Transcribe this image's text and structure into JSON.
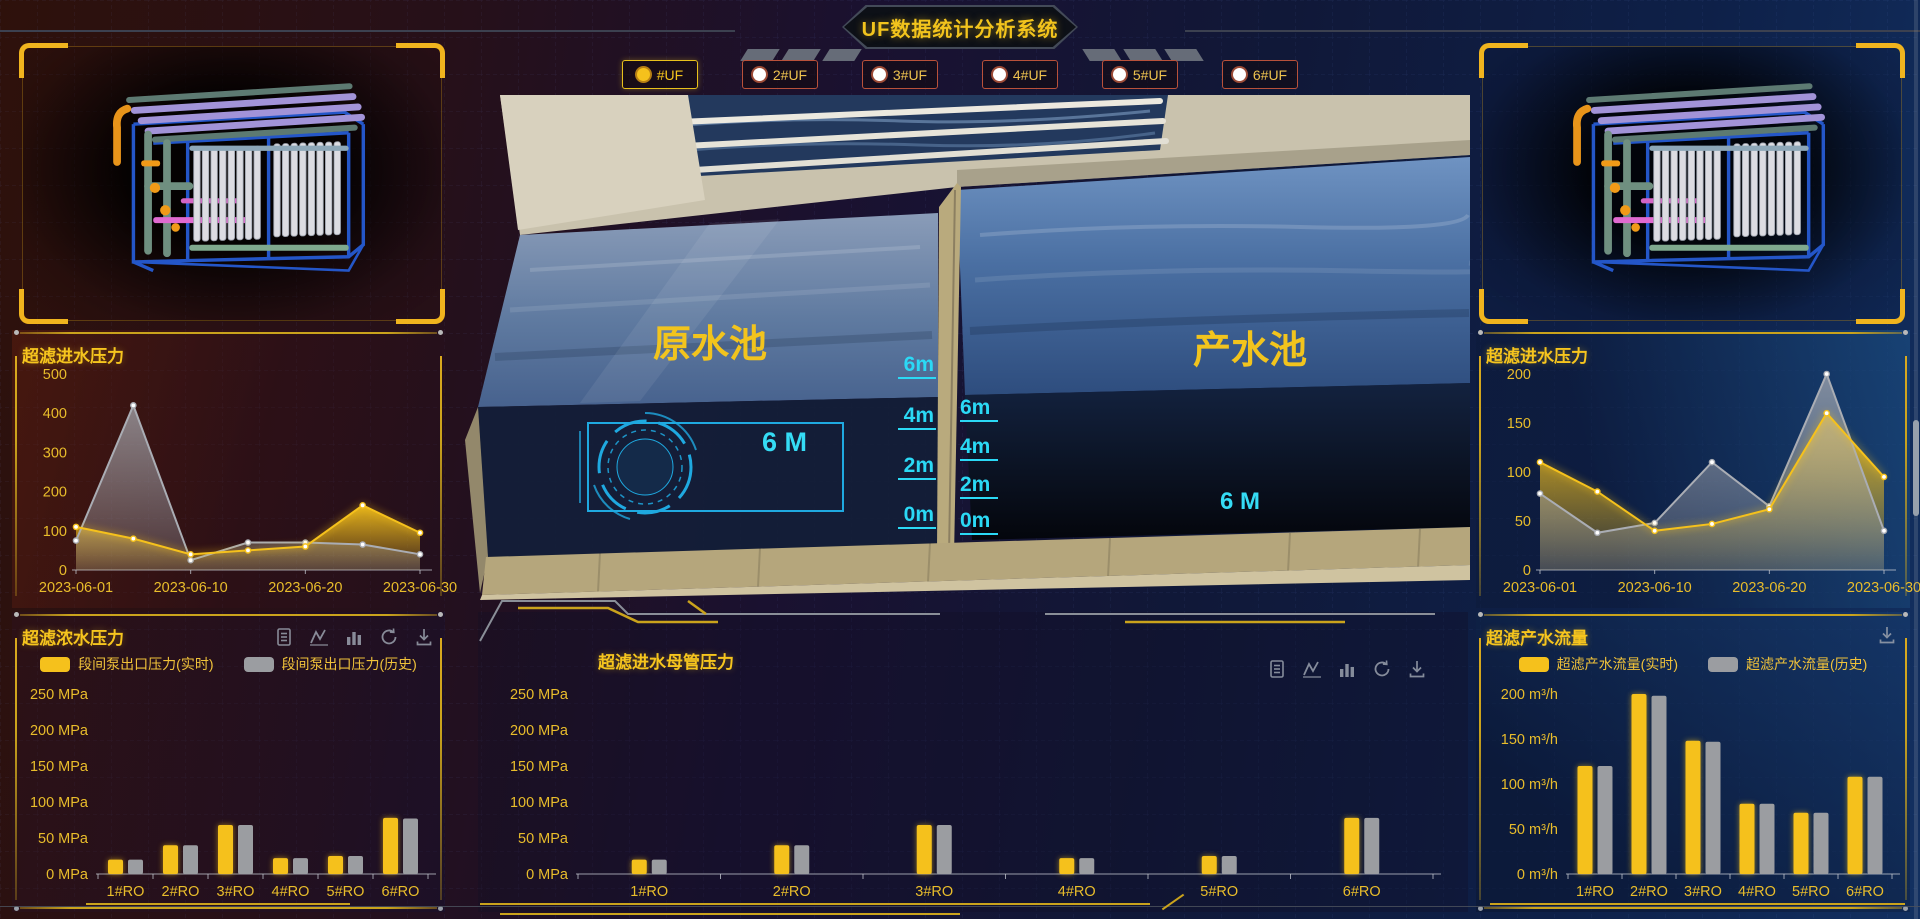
{
  "header": {
    "title": "UF数据统计分析系统"
  },
  "filter_bar": {
    "options": [
      {
        "label": "#UF",
        "selected": true
      },
      {
        "label": "2#UF",
        "selected": false
      },
      {
        "label": "3#UF",
        "selected": false
      },
      {
        "label": "4#UF",
        "selected": false
      },
      {
        "label": "5#UF",
        "selected": false
      },
      {
        "label": "6#UF",
        "selected": false
      }
    ]
  },
  "scene": {
    "pools": [
      {
        "label": "原水池",
        "level_text": "6 M"
      },
      {
        "label": "产水池",
        "level_text": "6 M"
      }
    ],
    "scale_labels": [
      "6m",
      "4m",
      "2m",
      "0m"
    ]
  },
  "toolbar_icons": [
    "data-list-icon",
    "line-chart-icon",
    "bar-chart-icon",
    "refresh-icon",
    "download-icon"
  ],
  "colors": {
    "accent_gold": "#f5c11c",
    "series_gray": "#9b9da1",
    "cyan": "#2bd9f5",
    "panel_border_gold": "#caa31c"
  },
  "chart_data": [
    {
      "type": "area",
      "title": "超滤进水压力",
      "x": [
        "2023-06-01",
        "2023-06-05",
        "2023-06-10",
        "2023-06-15",
        "2023-06-20",
        "2023-06-25",
        "2023-06-30"
      ],
      "x_tick_idx": [
        0,
        2,
        4,
        6
      ],
      "series": [
        {
          "name": "实时",
          "color": "#f5c11c",
          "values": [
            110,
            80,
            40,
            50,
            60,
            165,
            95
          ]
        },
        {
          "name": "历史",
          "color": "#aaadb4",
          "values": [
            75,
            420,
            25,
            70,
            70,
            65,
            40
          ]
        }
      ],
      "ylim": [
        0,
        500
      ],
      "yticks": [
        0,
        100,
        200,
        300,
        400,
        500
      ],
      "unit": "",
      "legend": "none",
      "grid": true
    },
    {
      "type": "area",
      "title": "超滤进水压力",
      "x": [
        "2023-06-01",
        "2023-06-05",
        "2023-06-10",
        "2023-06-15",
        "2023-06-20",
        "2023-06-25",
        "2023-06-30"
      ],
      "x_tick_idx": [
        0,
        2,
        4,
        6
      ],
      "series": [
        {
          "name": "实时",
          "color": "#f5c11c",
          "values": [
            110,
            80,
            40,
            47,
            62,
            160,
            95
          ]
        },
        {
          "name": "历史",
          "color": "#aaadb4",
          "values": [
            78,
            38,
            48,
            110,
            65,
            200,
            40
          ]
        }
      ],
      "ylim": [
        0,
        200
      ],
      "yticks": [
        0,
        50,
        100,
        150,
        200
      ],
      "unit": "",
      "legend": "none",
      "grid": true
    },
    {
      "type": "bar",
      "title": "超滤浓水压力",
      "categories": [
        "1#RO",
        "2#RO",
        "3#RO",
        "4#RO",
        "5#RO",
        "6#RO"
      ],
      "series": [
        {
          "name": "段间泵出口压力(实时)",
          "color": "#f5c11c",
          "values": [
            20,
            40,
            68,
            22,
            25,
            78
          ]
        },
        {
          "name": "段间泵出口压力(历史)",
          "color": "#9b9da1",
          "values": [
            20,
            40,
            68,
            22,
            25,
            77
          ]
        }
      ],
      "ylim": [
        0,
        250
      ],
      "yticks": [
        0,
        50,
        100,
        150,
        200,
        250
      ],
      "unit": "MPa",
      "legend": "top",
      "grid": true
    },
    {
      "type": "bar",
      "title": "超滤进水母管压力",
      "categories": [
        "1#RO",
        "2#RO",
        "3#RO",
        "4#RO",
        "5#RO",
        "6#RO"
      ],
      "series": [
        {
          "name": "实时",
          "color": "#f5c11c",
          "values": [
            20,
            40,
            68,
            22,
            25,
            78
          ]
        },
        {
          "name": "历史",
          "color": "#9b9da1",
          "values": [
            20,
            40,
            68,
            22,
            25,
            78
          ]
        }
      ],
      "ylim": [
        0,
        250
      ],
      "yticks": [
        0,
        50,
        100,
        150,
        200,
        250
      ],
      "unit": "MPa",
      "legend": "none",
      "grid": true
    },
    {
      "type": "bar",
      "title": "超滤产水流量",
      "categories": [
        "1#RO",
        "2#RO",
        "3#RO",
        "4#RO",
        "5#RO",
        "6#RO"
      ],
      "series": [
        {
          "name": "超滤产水流量(实时)",
          "color": "#f5c11c",
          "values": [
            120,
            200,
            148,
            78,
            68,
            108
          ]
        },
        {
          "name": "超滤产水流量(历史)",
          "color": "#9b9da1",
          "values": [
            120,
            198,
            147,
            78,
            68,
            108
          ]
        }
      ],
      "ylim": [
        0,
        200
      ],
      "yticks": [
        0,
        50,
        100,
        150,
        200
      ],
      "unit": "m³/h",
      "legend": "top",
      "grid": true
    }
  ]
}
